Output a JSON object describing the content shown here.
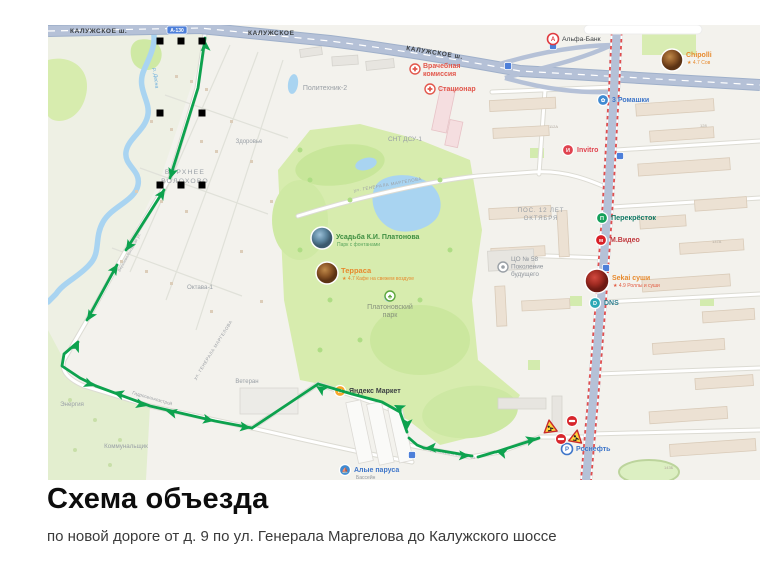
{
  "heading": {
    "title": "Схема объезда",
    "subtitle": "по новой дороге от д. 9 по ул. Генерала Маргелова до Калужского шоссе"
  },
  "map": {
    "colors": {
      "route_green": "#0da24e",
      "highway": "#b5c1d7",
      "water": "#a9d4f1",
      "park": "#d7ecae",
      "construction_red": "#e04f4f"
    },
    "route_badge": {
      "text": "А-130",
      "x": 177,
      "y": 30
    },
    "road_labels": [
      {
        "t": "КАЛУЖСКОЕ ш.",
        "x": 70,
        "y": 33,
        "s": 6.5,
        "c": "#3c4043",
        "b": 1,
        "ls": 0.6
      },
      {
        "t": "КАЛУЖСКОЕ",
        "x": 248,
        "y": 35,
        "s": 6.5,
        "c": "#3c4043",
        "b": 1,
        "ls": 0.6
      },
      {
        "t": "КАЛУЖСКОЕ ш.",
        "x": 406,
        "y": 50,
        "s": 6.5,
        "c": "#3c4043",
        "b": 1,
        "ls": 0.6,
        "r": 9
      },
      {
        "t": "ул. ГЕНЕРАЛА МАРГЕЛОВА",
        "x": 354,
        "y": 192,
        "s": 4.4,
        "c": "#9b9fa4",
        "ls": 0.5,
        "r": -10
      },
      {
        "t": "ул. ГЕНЕРАЛА МАРГЕЛОВА",
        "x": 196,
        "y": 380,
        "s": 4.4,
        "c": "#9b9fa4",
        "ls": 0.5,
        "r": -58
      },
      {
        "t": "ул. Генерала Маргелова",
        "x": 430,
        "y": 451,
        "s": 4.0,
        "c": "#a3a7ab",
        "r": 10
      },
      {
        "t": "Гидросельхозстрой",
        "x": 132,
        "y": 394,
        "s": 4.6,
        "c": "#9b9fa4",
        "r": 16
      },
      {
        "t": "Верхневолоховская ул.",
        "x": 120,
        "y": 272,
        "s": 4.0,
        "c": "#a3a7ab",
        "r": -61
      },
      {
        "t": "р. Десна",
        "x": 153,
        "y": 68,
        "s": 5.2,
        "c": "#6aaede",
        "r": 83,
        "i": 1
      }
    ],
    "area_labels": [
      {
        "lines": [
          "Политехник-2"
        ],
        "x": 325,
        "y": 90,
        "s": 7
      },
      {
        "lines": [
          "СНТ ДСУ-1"
        ],
        "x": 405,
        "y": 141,
        "s": 6.5
      },
      {
        "lines": [
          "Здоровье"
        ],
        "x": 249,
        "y": 143,
        "s": 6
      },
      {
        "lines": [
          "ВЕРХНЕЕ",
          "ВОЛОХОВО"
        ],
        "x": 185,
        "y": 174,
        "s": 6.8,
        "ls": 1.2
      },
      {
        "lines": [
          "Октава-1"
        ],
        "x": 200,
        "y": 289,
        "s": 6.2
      },
      {
        "lines": [
          "ПОС. 12 ЛЕТ",
          "ОКТЯБРЯ"
        ],
        "x": 541,
        "y": 212,
        "s": 6.2,
        "ls": 0.8
      },
      {
        "lines": [
          "Энергия"
        ],
        "x": 72,
        "y": 406,
        "s": 6.2
      },
      {
        "lines": [
          "Коммунальщик"
        ],
        "x": 126,
        "y": 448,
        "s": 6.2
      },
      {
        "lines": [
          "Ветеран"
        ],
        "x": 247,
        "y": 383,
        "s": 6
      }
    ],
    "house_numbers": [
      {
        "t": "112А",
        "x": 549,
        "y": 128
      },
      {
        "t": "128",
        "x": 700,
        "y": 127
      },
      {
        "t": "137А",
        "x": 712,
        "y": 243
      },
      {
        "t": "143Б",
        "x": 664,
        "y": 469
      }
    ],
    "pois": [
      {
        "id": "alfa-bank",
        "x": 553,
        "y": 39,
        "icon": {
          "t": "ring",
          "c": "#e03a3f",
          "glyph": "А"
        },
        "label": {
          "lines": [
            "Альфа-Банк"
          ],
          "x": 562,
          "y": 41,
          "c": "#3c4043",
          "s": 6.8
        }
      },
      {
        "id": "chipolli",
        "x": 672,
        "y": 60,
        "icon": {
          "t": "photo",
          "r": 11,
          "grad": "gB"
        },
        "label": {
          "lines": [
            "Chipolli"
          ],
          "x": 686,
          "y": 57,
          "c": "#e78a2e",
          "s": 7,
          "b": 1
        },
        "sub": {
          "t": "★ 4.7 Сов",
          "x": 687,
          "y": 64,
          "c": "#e78a2e",
          "s": 5
        }
      },
      {
        "id": "tri-romashki",
        "x": 603,
        "y": 100,
        "icon": {
          "t": "solid",
          "c": "#3f8ad1",
          "glyph": "✿"
        },
        "label": {
          "lines": [
            "3 Ромашки"
          ],
          "x": 612,
          "y": 102,
          "c": "#3f76c9",
          "s": 7,
          "b": 1
        }
      },
      {
        "id": "invitro",
        "x": 568,
        "y": 150,
        "icon": {
          "t": "solid",
          "c": "#e0434f",
          "glyph": "И"
        },
        "label": {
          "lines": [
            "Invitro"
          ],
          "x": 577,
          "y": 152,
          "c": "#e0434f",
          "s": 7,
          "b": 1
        }
      },
      {
        "id": "perekrestok",
        "x": 602,
        "y": 218,
        "icon": {
          "t": "solid",
          "c": "#14a05a",
          "glyph": "П"
        },
        "label": {
          "lines": [
            "Перекрёсток"
          ],
          "x": 611,
          "y": 220,
          "c": "#147a66",
          "s": 7.2,
          "b": 1
        }
      },
      {
        "id": "mvideo",
        "x": 601,
        "y": 240,
        "icon": {
          "t": "solid",
          "c": "#d81f26",
          "glyph": "м"
        },
        "label": {
          "lines": [
            "М.Видео"
          ],
          "x": 610,
          "y": 242,
          "c": "#c13a3f",
          "s": 7,
          "b": 1
        }
      },
      {
        "id": "sekai-sushi",
        "x": 597,
        "y": 281,
        "icon": {
          "t": "photo",
          "r": 12,
          "grad": "gC"
        },
        "label": {
          "lines": [
            "Sekai суши"
          ],
          "x": 612,
          "y": 280,
          "c": "#e78a2e",
          "s": 7,
          "b": 1
        },
        "sub": {
          "t": "★ 4.9 Роллы и суши",
          "x": 613,
          "y": 287,
          "c": "#e25a41",
          "s": 5
        }
      },
      {
        "id": "dns",
        "x": 595,
        "y": 303,
        "icon": {
          "t": "solid",
          "c": "#2aa7b5",
          "glyph": "D"
        },
        "label": {
          "lines": [
            "DNS"
          ],
          "x": 604,
          "y": 305,
          "c": "#2f7f8f",
          "s": 7,
          "b": 1
        }
      },
      {
        "id": "vrachebnaya-komissiya",
        "x": 415,
        "y": 69,
        "icon": {
          "t": "medical"
        },
        "label": {
          "lines": [
            "Врачебная",
            "комиссия"
          ],
          "x": 423,
          "y": 68,
          "c": "#e2574c",
          "s": 7,
          "b": 1
        }
      },
      {
        "id": "stacionar",
        "x": 430,
        "y": 89,
        "icon": {
          "t": "medical"
        },
        "label": {
          "lines": [
            "Стационар"
          ],
          "x": 438,
          "y": 91,
          "c": "#e2574c",
          "s": 7,
          "b": 1
        }
      },
      {
        "id": "usadba-platonova",
        "x": 322,
        "y": 238,
        "icon": {
          "t": "photo",
          "r": 11,
          "grad": "gA"
        },
        "label": {
          "lines": [
            "Усадьба К.И. Платонова"
          ],
          "x": 336,
          "y": 239,
          "c": "#3e8e41",
          "s": 7,
          "b": 1
        },
        "sub": {
          "t": "Парк с фонтанами",
          "x": 337,
          "y": 246,
          "c": "#5aa55d",
          "s": 5
        }
      },
      {
        "id": "terrasa",
        "x": 327,
        "y": 273,
        "icon": {
          "t": "photo",
          "r": 11,
          "grad": "gB"
        },
        "label": {
          "lines": [
            "Терраса"
          ],
          "x": 341,
          "y": 273,
          "c": "#e78a2e",
          "s": 7.5,
          "b": 1
        },
        "sub": {
          "t": "★ 4.7 Кафе на свежем воздухе",
          "x": 342,
          "y": 280,
          "c": "#e78a2e",
          "s": 5
        }
      },
      {
        "id": "platonovsky-park",
        "x": 390,
        "y": 296,
        "icon": {
          "t": "tree"
        },
        "label": {
          "lines": [
            "Платоновский",
            "парк"
          ],
          "x": 390,
          "y": 309,
          "c": "#87927c",
          "s": 7,
          "a": "middle"
        }
      },
      {
        "id": "co-58",
        "x": 503,
        "y": 267,
        "icon": {
          "t": "school"
        },
        "label": {
          "lines": [
            "ЦО № 58",
            "Поколение",
            "будущего"
          ],
          "x": 511,
          "y": 261,
          "c": "#8f959c",
          "s": 6.4
        }
      },
      {
        "id": "yandex-market",
        "x": 340,
        "y": 391,
        "icon": {
          "t": "solid",
          "c": "#f8a72c",
          "glyph": "М"
        },
        "label": {
          "lines": [
            "Яндекс Маркет"
          ],
          "x": 349,
          "y": 393,
          "c": "#3c4043",
          "s": 7,
          "b": 1
        }
      },
      {
        "id": "alye-parusa",
        "x": 345,
        "y": 470,
        "icon": {
          "t": "solid",
          "c": "#3f8ad1",
          "glyph": "⛵"
        },
        "label": {
          "lines": [
            "Алые паруса"
          ],
          "x": 354,
          "y": 472,
          "c": "#3f76c9",
          "s": 7,
          "b": 1
        },
        "sub": {
          "t": "Бассейн",
          "x": 356,
          "y": 479,
          "c": "#8f959c",
          "s": 5
        }
      },
      {
        "id": "rosneft",
        "x": 567,
        "y": 449,
        "icon": {
          "t": "ring",
          "c": "#3f76c9",
          "glyph": "Р"
        },
        "label": {
          "lines": [
            "Роснефть"
          ],
          "x": 576,
          "y": 451,
          "c": "#3f76c9",
          "s": 7,
          "b": 1
        }
      }
    ],
    "badges": [
      {
        "x": 508,
        "y": 66
      },
      {
        "x": 553,
        "y": 46
      },
      {
        "x": 412,
        "y": 455
      },
      {
        "x": 620,
        "y": 156
      },
      {
        "x": 606,
        "y": 268
      }
    ],
    "route": {
      "color": "#0da24e",
      "segments": [
        [
          [
            205,
            38
          ],
          [
            198,
            88
          ],
          [
            170,
            178
          ]
        ],
        [
          [
            164,
            190
          ],
          [
            126,
            250
          ]
        ],
        [
          [
            117,
            265
          ],
          [
            87,
            320
          ]
        ],
        [
          [
            78,
            342
          ],
          [
            64,
            354
          ],
          [
            62,
            366
          ],
          [
            80,
            378
          ],
          [
            96,
            386
          ]
        ],
        [
          [
            96,
            386
          ],
          [
            150,
            406
          ],
          [
            215,
            421
          ],
          [
            252,
            428
          ]
        ],
        [
          [
            252,
            428
          ],
          [
            318,
            384
          ]
        ],
        [
          [
            318,
            384
          ],
          [
            352,
            394
          ],
          [
            382,
            402
          ],
          [
            400,
            412
          ],
          [
            407,
            432
          ]
        ],
        [
          [
            409,
            438
          ],
          [
            417,
            445
          ],
          [
            424,
            448
          ]
        ],
        [
          [
            424,
            448
          ],
          [
            472,
            456
          ]
        ],
        [
          [
            478,
            457
          ],
          [
            495,
            452
          ]
        ],
        [
          [
            496,
            452
          ],
          [
            539,
            438
          ]
        ]
      ],
      "arrows": [
        [
          205,
          40,
          -93
        ],
        [
          170,
          179,
          107
        ],
        [
          165,
          189,
          -57
        ],
        [
          126,
          251,
          122
        ],
        [
          118,
          264,
          -57
        ],
        [
          87,
          321,
          122
        ],
        [
          79,
          341,
          -65
        ],
        [
          95,
          386,
          20
        ],
        [
          113,
          392,
          197
        ],
        [
          147,
          406,
          15
        ],
        [
          166,
          411,
          195
        ],
        [
          214,
          421,
          12
        ],
        [
          251,
          428,
          8
        ],
        [
          316,
          386,
          213
        ],
        [
          394,
          405,
          207
        ],
        [
          407,
          430,
          93
        ],
        [
          425,
          448,
          178
        ],
        [
          470,
          456,
          3
        ],
        [
          496,
          451,
          196
        ],
        [
          537,
          438,
          -17
        ]
      ]
    },
    "handles": [
      [
        160,
        41
      ],
      [
        181,
        41
      ],
      [
        202,
        41
      ],
      [
        160,
        113
      ],
      [
        202,
        113
      ],
      [
        160,
        185
      ],
      [
        181,
        185
      ],
      [
        202,
        185
      ]
    ],
    "signs": [
      {
        "type": "roadworks",
        "x": 550,
        "y": 427,
        "rot": -8
      },
      {
        "type": "no-entry",
        "x": 572,
        "y": 421
      },
      {
        "type": "no-entry",
        "x": 561,
        "y": 439
      },
      {
        "type": "roadworks",
        "x": 576,
        "y": 437,
        "rot": 10
      }
    ]
  }
}
